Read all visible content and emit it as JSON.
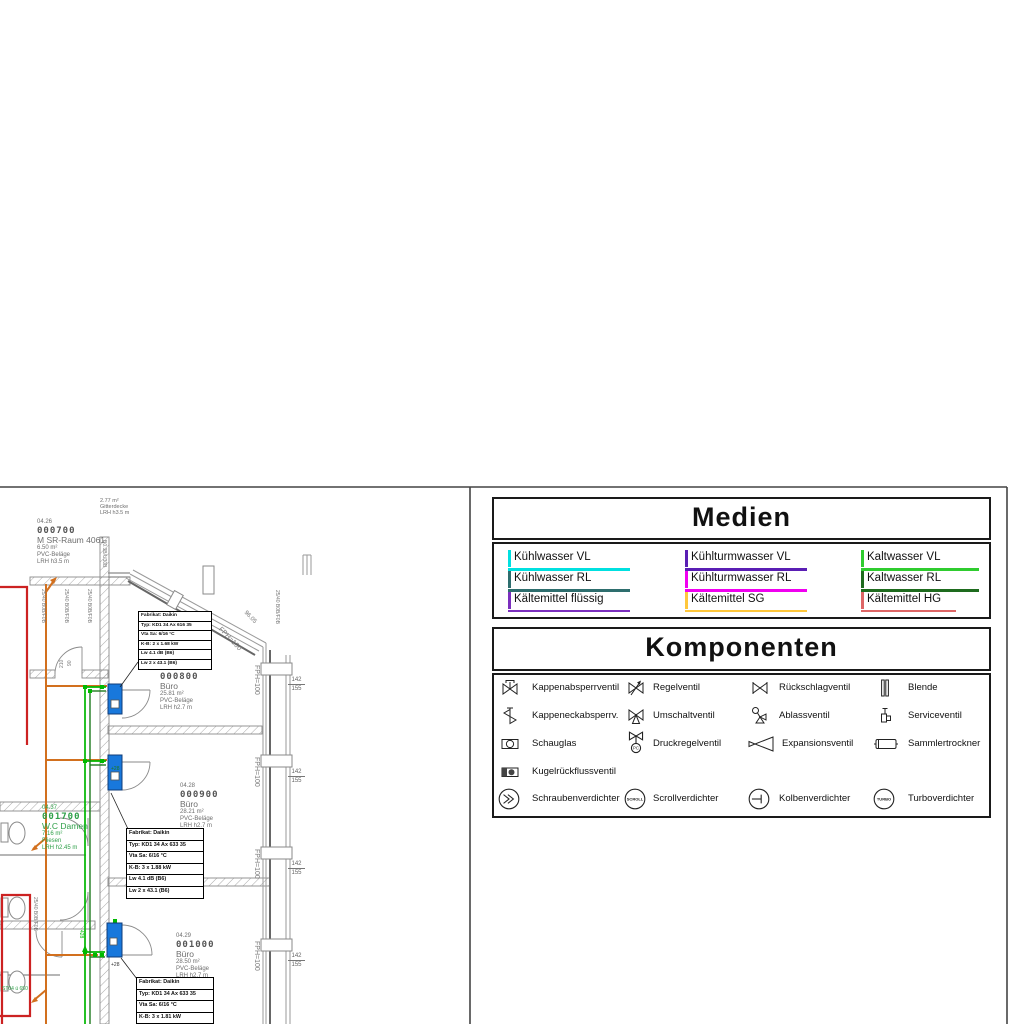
{
  "plan": {
    "shaft_label": {
      "area": "2.77 m²",
      "name": "Gitterdecke",
      "height": "LRH h3.5 m"
    },
    "rooms": [
      {
        "id": "04.26",
        "code": "000700",
        "name": "M SR-Raum 4061",
        "area": "6.50 m²",
        "floor": "PVC-Beläge",
        "height": "LRH h3.5 m"
      },
      {
        "id": "04.27",
        "code": "000800",
        "name": "Büro",
        "area": "25.81 m²",
        "floor": "PVC-Beläge",
        "height": "LRH h2.7 m"
      },
      {
        "id": "04.28",
        "code": "000900",
        "name": "Büro",
        "area": "28.21 m²",
        "floor": "PVC-Beläge",
        "height": "LRH h2.7 m"
      },
      {
        "id": "04.29",
        "code": "001000",
        "name": "Büro",
        "area": "28.50 m²",
        "floor": "PVC-Beläge",
        "height": "LRH h2.7 m"
      },
      {
        "id": "04.37",
        "code": "001700",
        "name": "W.C Damen",
        "area": "7.16 m²",
        "floor": "Fliesen",
        "height": "LRH h2.45 m"
      }
    ],
    "facade_label": "FPH=100",
    "facade_dim": "96.05",
    "window_label_top": "142",
    "window_label_bottom": "155",
    "door_tag": "25/40 B0B/F0B",
    "wall_tag": "B0.3B/U30B",
    "door_width": "90",
    "door_height": "210",
    "pipe_label_riser": "428",
    "pipe_label_unit": "+28",
    "pipe_note": "ST04 ü 650",
    "tables": [
      {
        "rows": [
          "Fabrikat: Daikin",
          "Typ: KD1 34 Ax 616 35",
          "Vta Sa: 6/16 °C",
          "K-B: 2 x 1.68 kW",
          "Lw 4.1 dB (B6)",
          "Lw 2 x 43.1 (B6)"
        ]
      },
      {
        "rows": [
          "Fabrikat: Daikin",
          "Typ: KD1 34 Ax 633 35",
          "Vta Sa: 6/16 °C",
          "K-B: 3 x 1.88 kW",
          "Lw 4.1 dB (B6)",
          "Lw 2 x 43.1 (B6)"
        ]
      },
      {
        "rows": [
          "Fabrikat: Daikin",
          "Typ: KD1 34 Ax 633 35",
          "Vta Sa: 6/16 °C",
          "K-B: 3 x 1.81 kW",
          "Lw 6.6 dB (B6)",
          "Lw 2 x 43.1 (B6)"
        ]
      }
    ],
    "colors": {
      "pipe_orange": "#D2701E",
      "pipe_green_vl": "#00B800",
      "pipe_green_rl": "#1E7A1E",
      "unit_blue": "#1878DC",
      "zone_red": "#CC2222"
    }
  },
  "legend_medien": {
    "title": "Medien",
    "items": [
      {
        "label": "Kühlwasser VL",
        "color": "#00E0E0"
      },
      {
        "label": "Kühlwasser RL",
        "color": "#2E6E6E"
      },
      {
        "label": "Kältemittel flüssig",
        "color": "#7B2FBE"
      },
      {
        "label": "Kühlturmwasser VL",
        "color": "#5A1EB4"
      },
      {
        "label": "Kühlturmwasser RL",
        "color": "#F000F0"
      },
      {
        "label": "Kältemittel SG",
        "color": "#FFC73B"
      },
      {
        "label": "Kaltwasser VL",
        "color": "#2FCC2F"
      },
      {
        "label": "Kaltwasser RL",
        "color": "#1E6B1E"
      },
      {
        "label": "Kältemittel HG",
        "color": "#DE6666"
      }
    ]
  },
  "legend_komponenten": {
    "title": "Komponenten",
    "items": [
      {
        "label": "Kappenabsperrventil"
      },
      {
        "label": "Regelventil"
      },
      {
        "label": "Rückschlagventil"
      },
      {
        "label": "Blende"
      },
      {
        "label": "Kappeneckabsperrv."
      },
      {
        "label": "Umschaltventil"
      },
      {
        "label": "Ablassventil"
      },
      {
        "label": "Serviceventil"
      },
      {
        "label": "Schauglas"
      },
      {
        "label": "Druckregelventil",
        "icon_text": "PC"
      },
      {
        "label": "Expansionsventil"
      },
      {
        "label": "Sammlertrockner"
      },
      {
        "label": "Kugelrückflussventil"
      },
      {
        "label": "Schraubenverdichter"
      },
      {
        "label": "Scrollverdichter",
        "icon_text": "SCROLL"
      },
      {
        "label": "Kolbenverdichter"
      },
      {
        "label": "Turboverdichter",
        "icon_text": "TURBO"
      }
    ]
  }
}
